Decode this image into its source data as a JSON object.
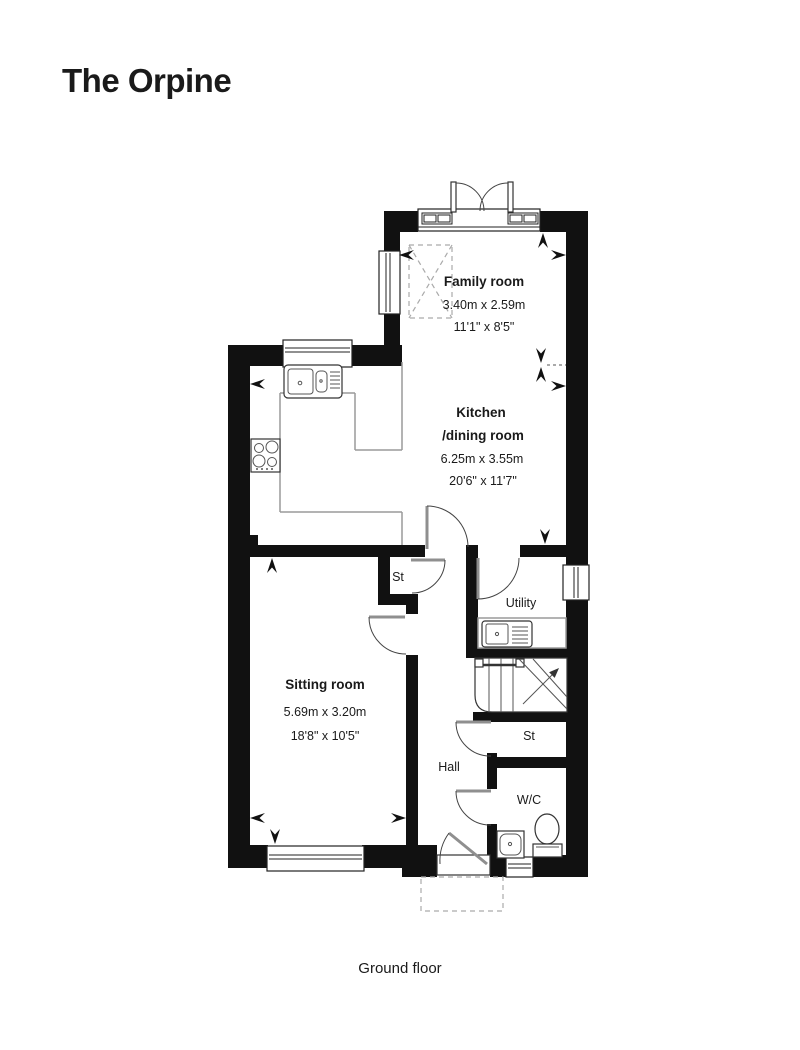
{
  "title": "The Orpine",
  "title_color": "#2ea873",
  "floor_label": "Ground floor",
  "rooms": {
    "family": {
      "name": "Family room",
      "metric": "3.40m x 2.59m",
      "imperial": "11'1\" x 8'5\""
    },
    "kitchen": {
      "name": "Kitchen",
      "name2": "/dining room",
      "metric": "6.25m x 3.55m",
      "imperial": "20'6\" x 11'7\""
    },
    "sitting": {
      "name": "Sitting room",
      "metric": "5.69m x 3.20m",
      "imperial": "18'8\" x 10'5\""
    },
    "utility": {
      "name": "Utility"
    },
    "hall": {
      "name": "Hall"
    },
    "store_upper": {
      "name": "St"
    },
    "store_lower": {
      "name": "St"
    },
    "wc": {
      "name": "W/C"
    }
  },
  "colors": {
    "wall": "#111111",
    "counter": "#9a9a9a",
    "accent_green": "#2ea873"
  }
}
